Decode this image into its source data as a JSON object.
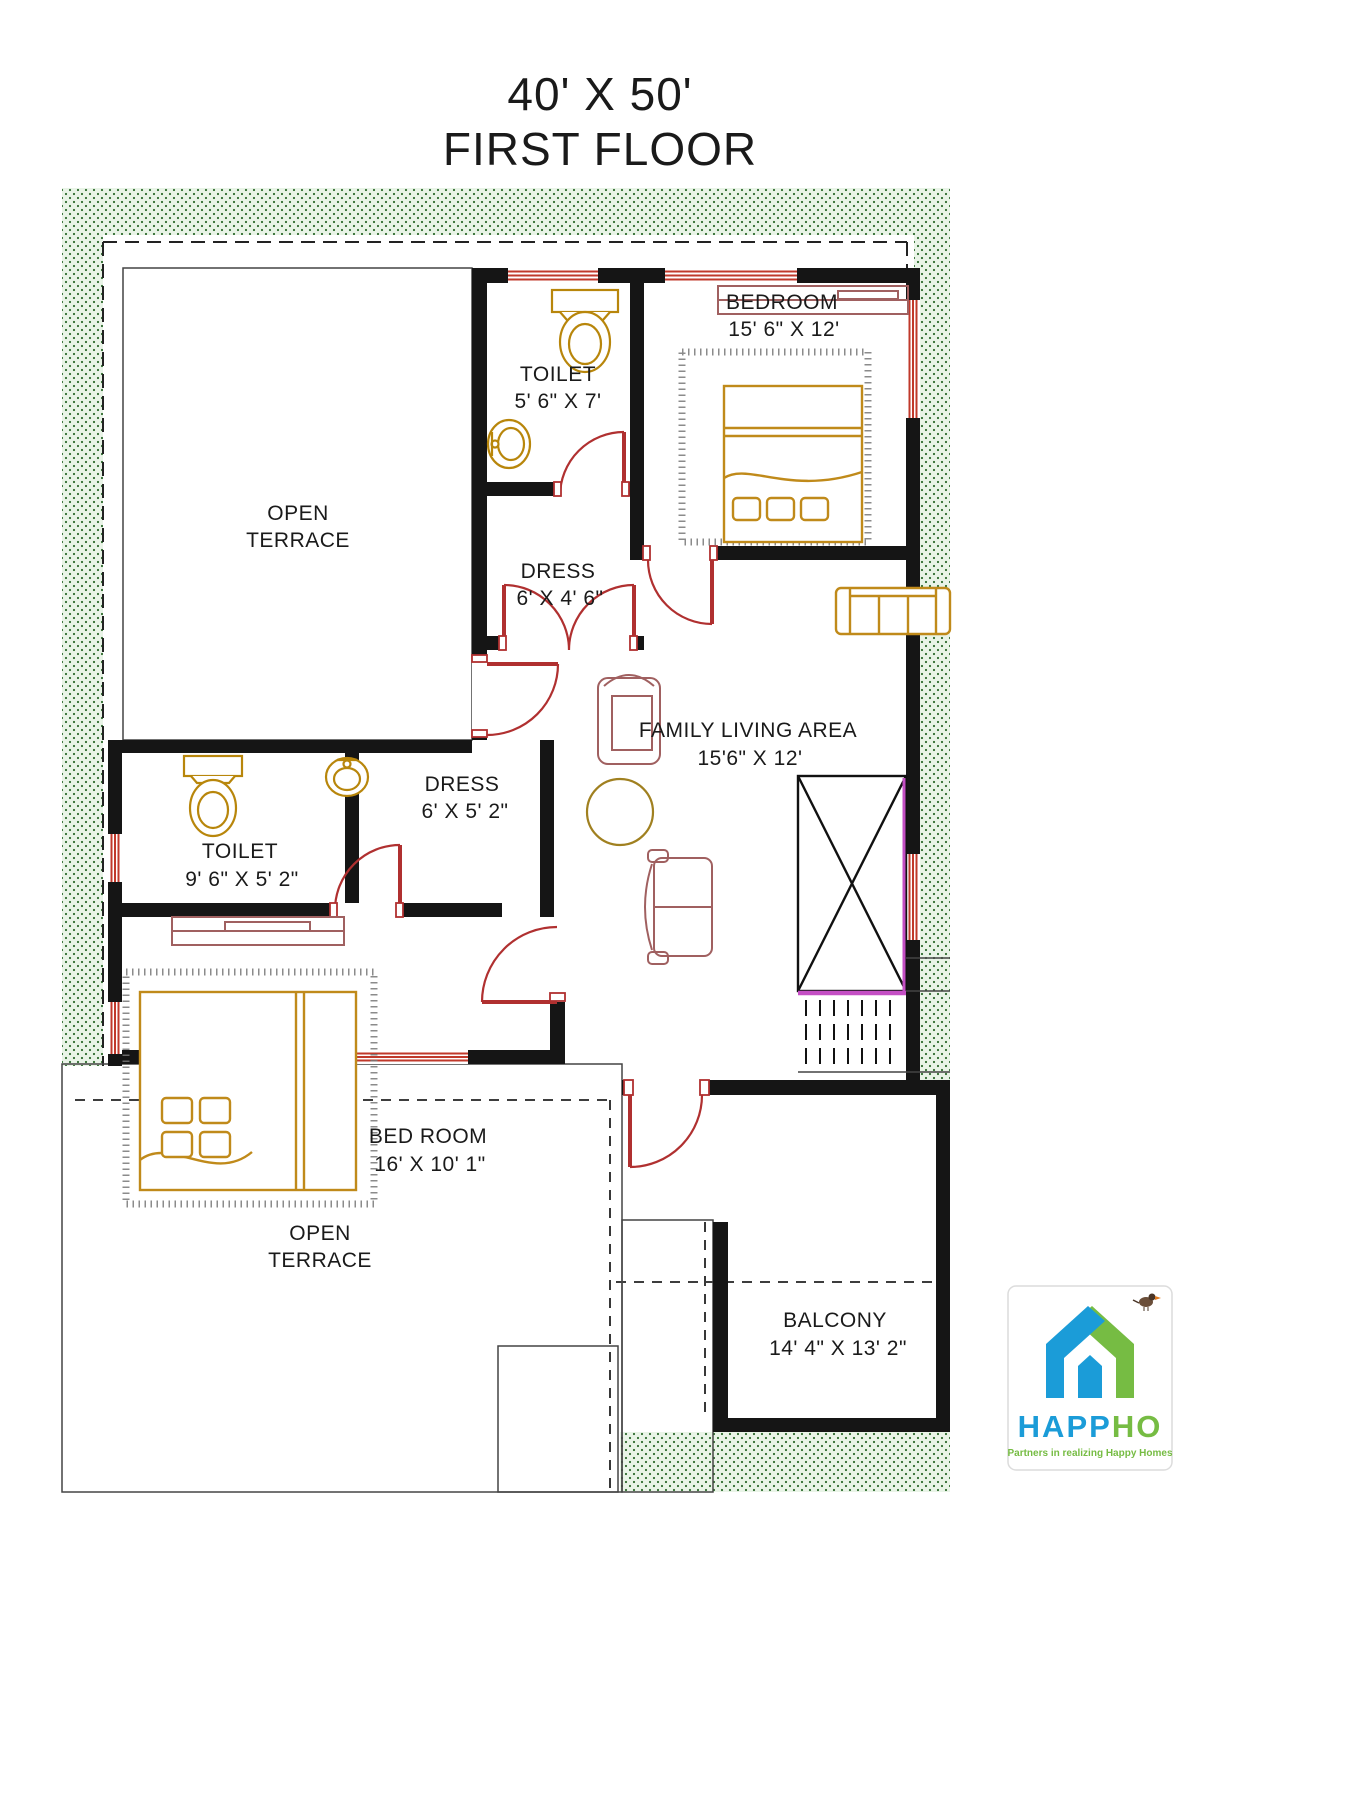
{
  "title": {
    "line1": "40' X 50'",
    "line2": "FIRST FLOOR"
  },
  "rooms": {
    "terrace_top": {
      "line1": "OPEN",
      "line2": "TERRACE"
    },
    "toilet_top": {
      "name": "TOILET",
      "dims": "5' 6\" X 7'"
    },
    "dress_top": {
      "name": "DRESS",
      "dims": "6' X 4' 6\""
    },
    "bedroom_top": {
      "name": "BEDROOM",
      "dims": "15' 6\" X 12'"
    },
    "family": {
      "name": "FAMILY LIVING AREA",
      "dims": "15'6\" X 12'"
    },
    "dress_mid": {
      "name": "DRESS",
      "dims": "6' X 5' 2\""
    },
    "toilet_left": {
      "name": "TOILET",
      "dims": "9' 6\" X 5' 2\""
    },
    "bedroom_bottom": {
      "name": "BED ROOM",
      "dims": "16' X 10' 1\""
    },
    "balcony": {
      "name": "BALCONY",
      "dims": "14' 4\" X 13' 2\""
    },
    "terrace_bottom": {
      "line1": "OPEN",
      "line2": "TERRACE"
    }
  },
  "logo": {
    "brand_blue": "HAPP",
    "brand_green": "HO",
    "tagline": "Partners in realizing Happy Homes"
  },
  "colors": {
    "wall": "#151515",
    "door_red": "#b03030",
    "fixture_gold": "#b8860b",
    "furniture_rose": "#a06060",
    "stipple_green": "#2e6b2e",
    "stair_magenta": "#c44fc4",
    "logo_blue": "#1b9cd8",
    "logo_green": "#76bc43",
    "brick_line": "#9a9a9a"
  }
}
